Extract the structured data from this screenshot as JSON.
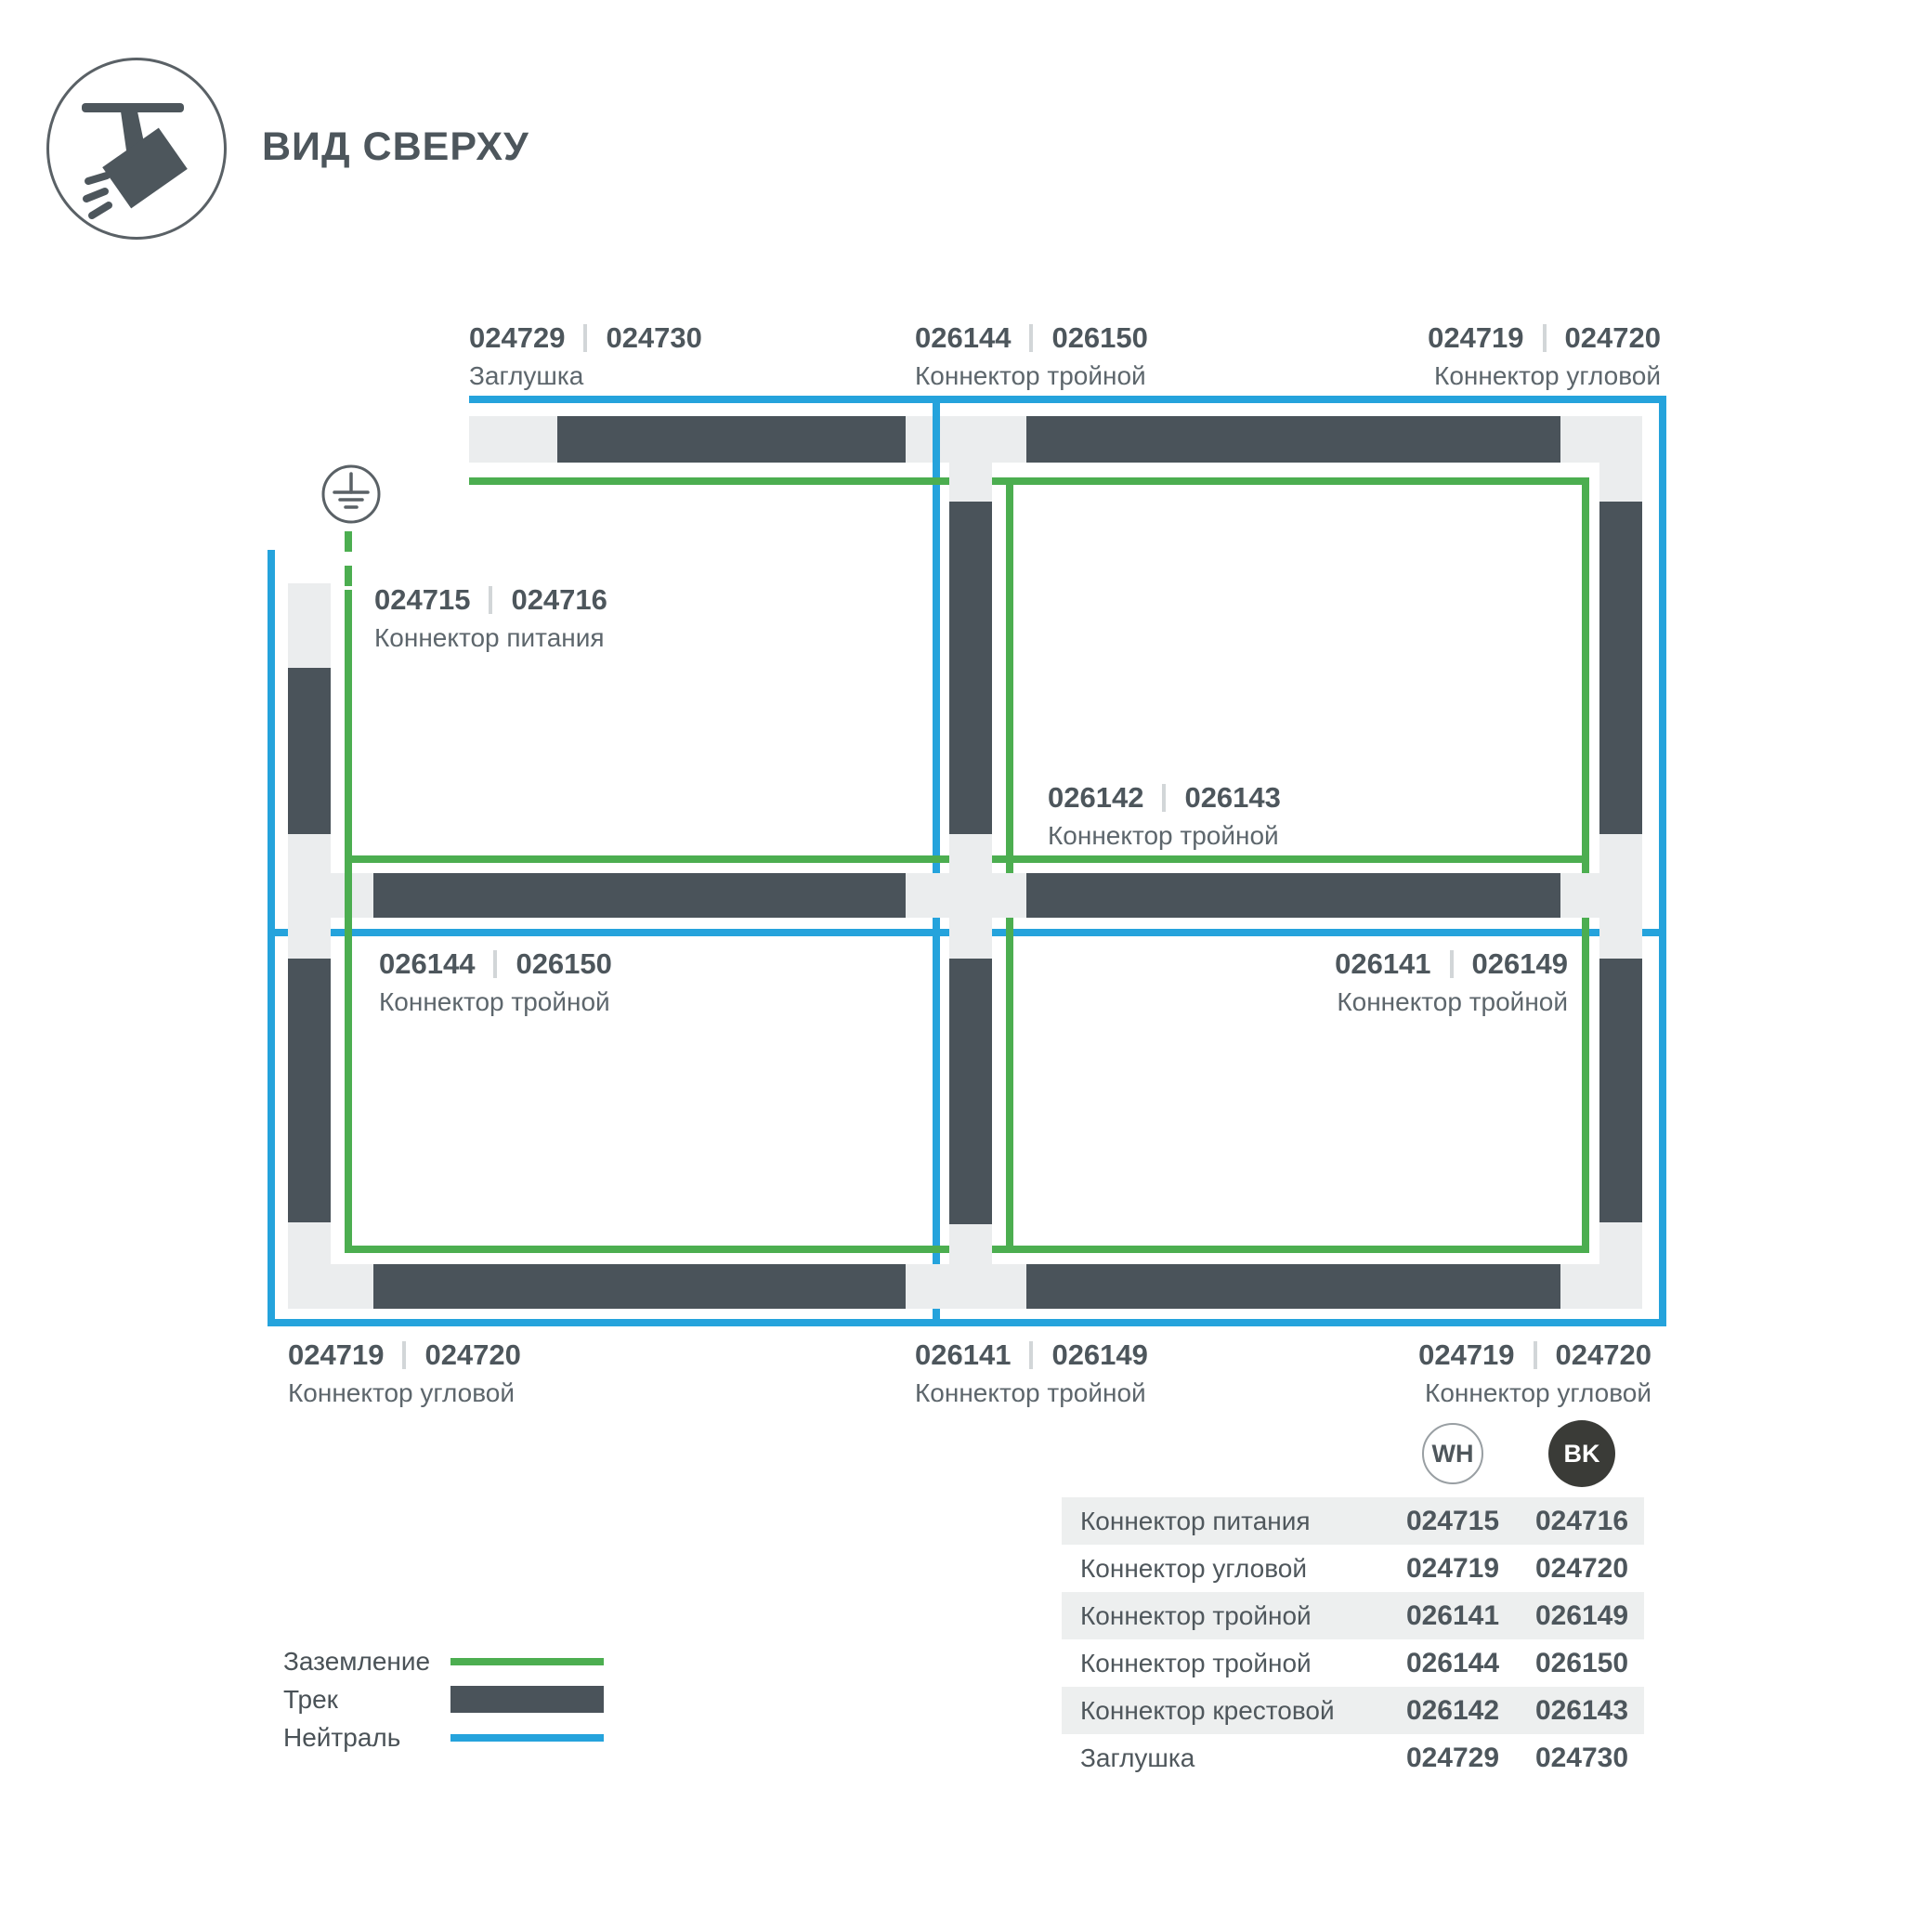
{
  "header": {
    "icon": "track-spotlight-icon",
    "title": "ВИД СВЕРХУ"
  },
  "colors": {
    "ground": "#4cae50",
    "neutral": "#25a3dc",
    "track": "#4a535a"
  },
  "diagram": {
    "ground_icon": "ground-earth-icon",
    "labels": [
      {
        "id": "cap-top",
        "codes": [
          "024729",
          "024730"
        ],
        "caption": "Заглушка"
      },
      {
        "id": "triple-top",
        "codes": [
          "026144",
          "026150"
        ],
        "caption": "Коннектор тройной"
      },
      {
        "id": "corner-top-right",
        "codes": [
          "024719",
          "024720"
        ],
        "caption": "Коннектор угловой",
        "align": "right"
      },
      {
        "id": "power",
        "codes": [
          "024715",
          "024716"
        ],
        "caption": "Коннектор питания"
      },
      {
        "id": "cross-center",
        "codes": [
          "026142",
          "026143"
        ],
        "caption": "Коннектор тройной"
      },
      {
        "id": "triple-mid-left",
        "codes": [
          "026144",
          "026150"
        ],
        "caption": "Коннектор тройной"
      },
      {
        "id": "triple-mid-right",
        "codes": [
          "026141",
          "026149"
        ],
        "caption": "Коннектор тройной",
        "align": "right"
      },
      {
        "id": "corner-bottom-left",
        "codes": [
          "024719",
          "024720"
        ],
        "caption": "Коннектор угловой"
      },
      {
        "id": "triple-bottom",
        "codes": [
          "026141",
          "026149"
        ],
        "caption": "Коннектор тройной"
      },
      {
        "id": "corner-bottom-right",
        "codes": [
          "024719",
          "024720"
        ],
        "caption": "Коннектор угловой",
        "align": "right"
      }
    ]
  },
  "legend": {
    "items": [
      {
        "id": "ground",
        "label": "Заземление",
        "swatch": "ground-line"
      },
      {
        "id": "track",
        "label": "Трек",
        "swatch": "track-bar"
      },
      {
        "id": "neutral",
        "label": "Нейтраль",
        "swatch": "neutral-line"
      }
    ]
  },
  "table": {
    "columns": [
      {
        "id": "wh",
        "label": "WH"
      },
      {
        "id": "bk",
        "label": "BK"
      }
    ],
    "rows": [
      {
        "name": "Коннектор питания",
        "wh": "024715",
        "bk": "024716"
      },
      {
        "name": "Коннектор угловой",
        "wh": "024719",
        "bk": "024720"
      },
      {
        "name": "Коннектор тройной",
        "wh": "026141",
        "bk": "026149"
      },
      {
        "name": "Коннектор тройной",
        "wh": "026144",
        "bk": "026150"
      },
      {
        "name": "Коннектор крестовой",
        "wh": "026142",
        "bk": "026143"
      },
      {
        "name": "Заглушка",
        "wh": "024729",
        "bk": "024730"
      }
    ]
  }
}
